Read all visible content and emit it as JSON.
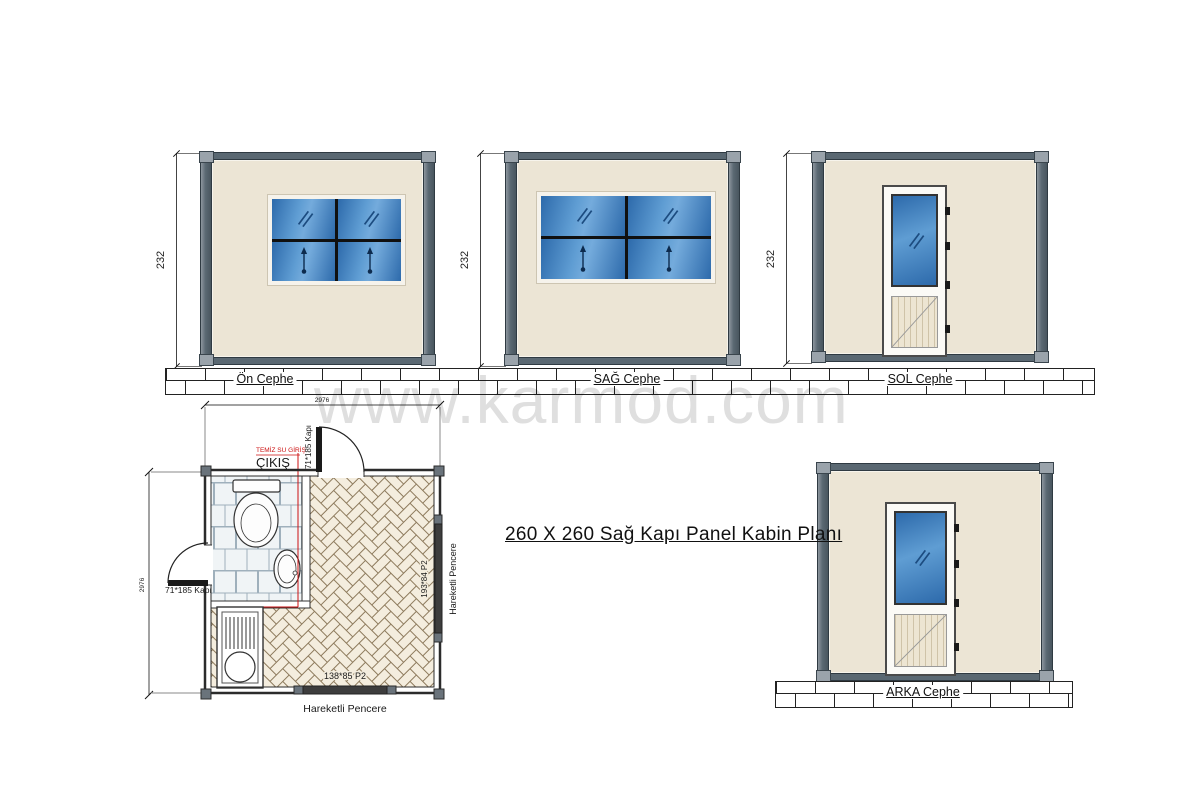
{
  "watermark": "www.karmod.com",
  "title": "260 X 260  Sağ Kapı Panel Kabin Planı",
  "elevations": {
    "front": {
      "label": "Ön Cephe",
      "dim": "232"
    },
    "right": {
      "label": "SAĞ Cephe",
      "dim": "232"
    },
    "left": {
      "label": "SOL Cephe",
      "dim": "232"
    },
    "back": {
      "label": "ARKA Cephe"
    }
  },
  "plan": {
    "dim_width": "2976",
    "dim_height": "2976",
    "exit_label": "ÇIKIŞ",
    "clean_water_label": "TEMİZ SU GİRİŞ",
    "door_top_label": "71*185 Kapı",
    "door_left_label": "71*185 Kapı",
    "window_right_size": "193*84 P2",
    "window_right_type": "Hareketli Pencere",
    "window_bottom_size": "138*85 P2",
    "window_bottom_type": "Hareketli Pencere"
  },
  "colors": {
    "wall_fill": "#ece5d5",
    "frame_steel": "#5a6872",
    "glass_blue": "#3a76b4",
    "floor_line": "#8d7a5c",
    "pipe_red": "#cc1111",
    "watermark_gray": "#c9c9c9"
  }
}
